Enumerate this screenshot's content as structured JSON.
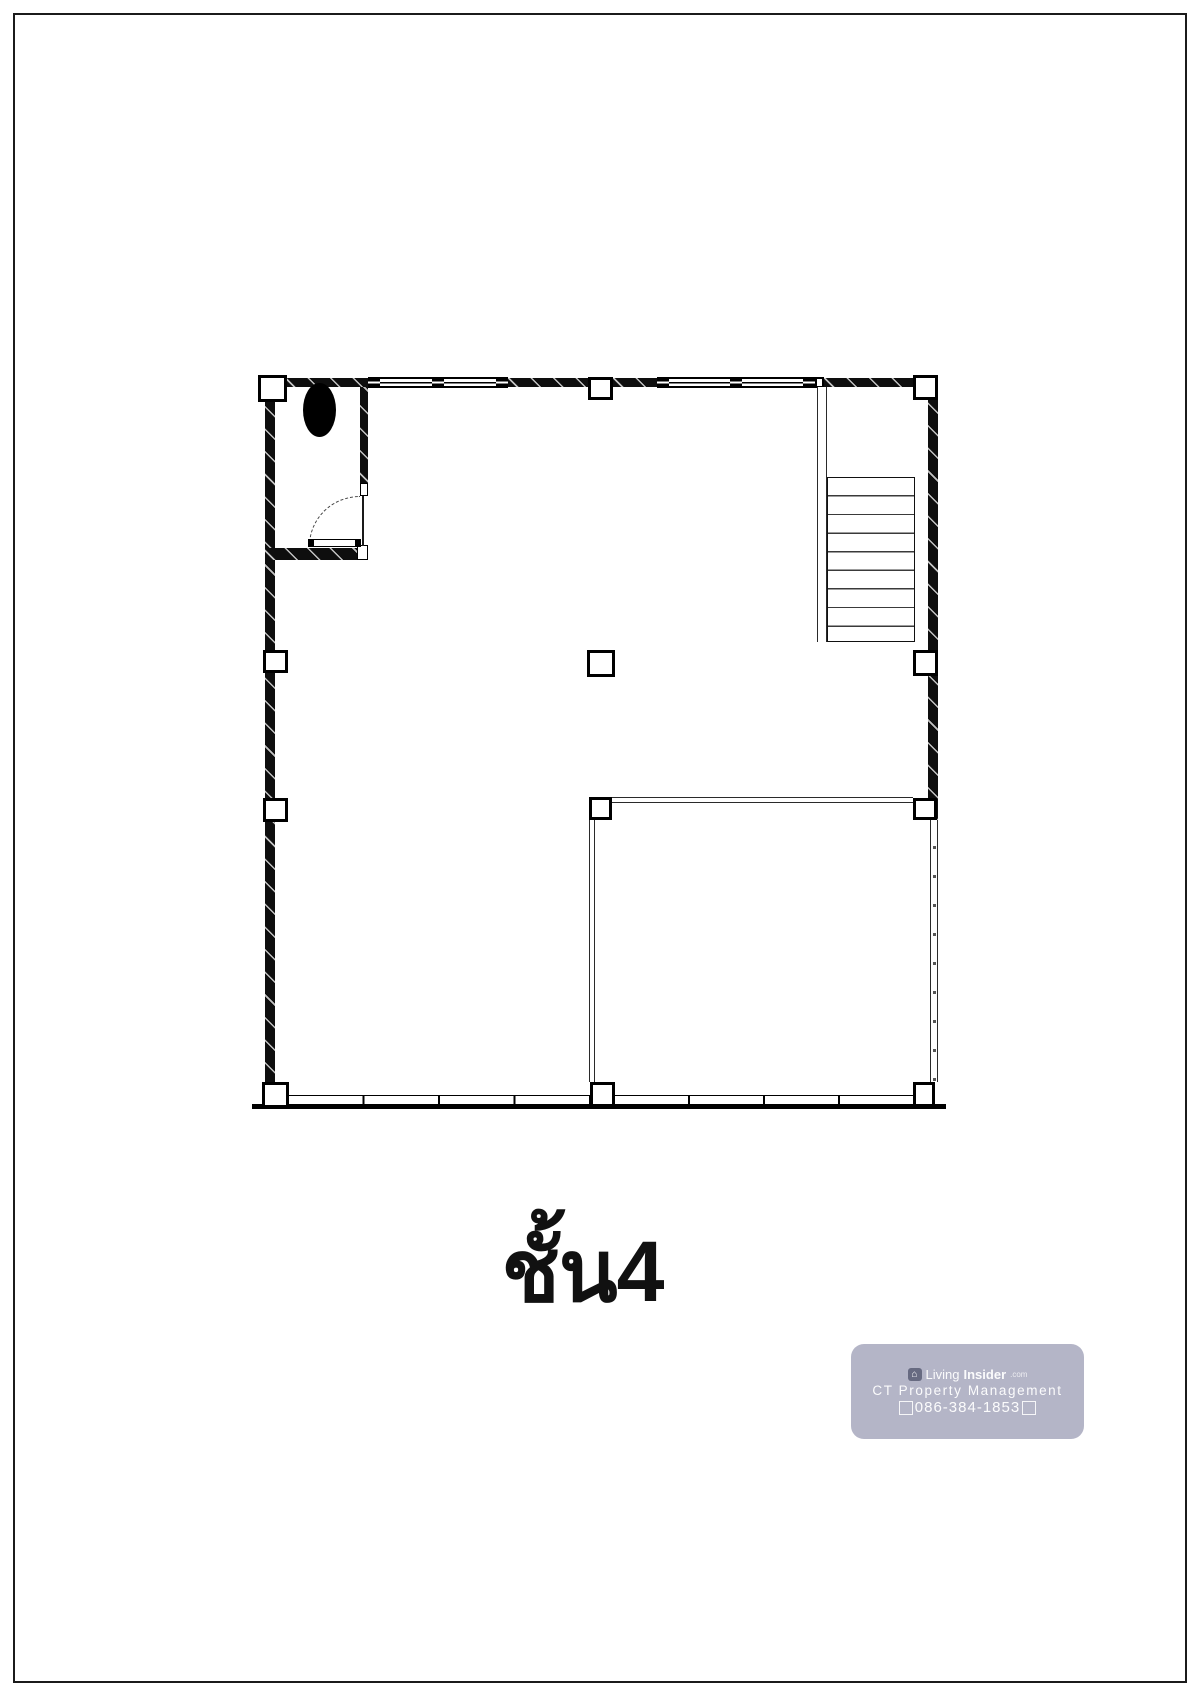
{
  "page": {
    "background": "#ffffff",
    "border_color": "#1b1b1b"
  },
  "title": {
    "text": "ชั้น4"
  },
  "watermark": {
    "brand_light": "Living",
    "brand_bold": "Insider",
    "brand_suffix": ".com",
    "company": "CT Property Management",
    "phone": "086-384-1853",
    "box_color": "#b4b5c7",
    "text_color": "#ffffff"
  },
  "plan": {
    "line_color": "#0e0e0e",
    "stair_tread_count": 9,
    "column_grid": {
      "x_axes": 3,
      "y_axes": 4
    }
  }
}
